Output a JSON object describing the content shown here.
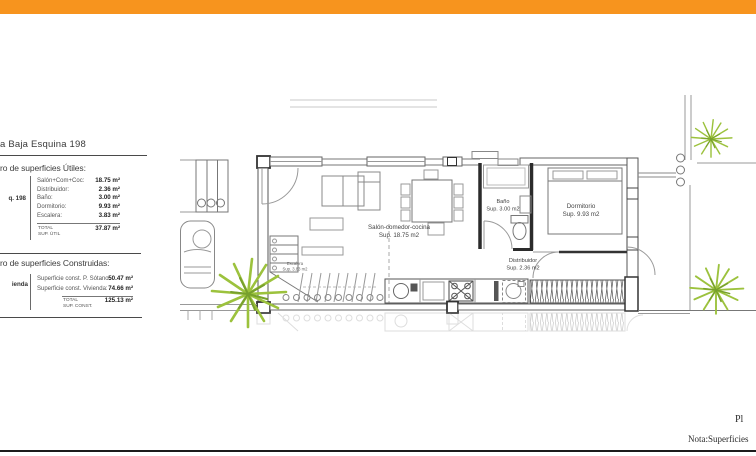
{
  "page": {
    "accent_bar_color": "#F7941E",
    "background": "#ffffff"
  },
  "title": "a Baja Esquina 198",
  "surfaces_utiles": {
    "heading": "ro de superficies Útiles:",
    "side_label": "q. 198",
    "rows": [
      {
        "label": "Salón+Com+Coc:",
        "value": "18.75 m²"
      },
      {
        "label": "Distribuidor:",
        "value": "2.36 m²"
      },
      {
        "label": "Baño:",
        "value": "3.00 m²"
      },
      {
        "label": "Dormitorio:",
        "value": "9.93 m²"
      },
      {
        "label": "Escalera:",
        "value": "3.83 m²"
      }
    ],
    "total": {
      "label_line1": "TOTAL",
      "label_line2": "SUP. ÚTIL",
      "value": "37.87 m²"
    }
  },
  "surfaces_construidas": {
    "heading": "ro de superficies Construidas:",
    "side_label": "ienda",
    "rows": [
      {
        "label": "Superficie const. P. Sótano:",
        "value": "50.47 m²"
      },
      {
        "label": "Superficie const. Vivienda:",
        "value": "74.66 m²"
      }
    ],
    "total": {
      "label_line1": "TOTAL",
      "label_line2": "SUP. CONST.",
      "value": "125.13 m²"
    }
  },
  "floor_plan": {
    "rooms": {
      "salon": {
        "name": "Salón-comedor-cocina",
        "area": "Sup. 18.75 m2"
      },
      "bano": {
        "name": "Baño",
        "area": "Sup. 3.00 m2"
      },
      "dormitorio": {
        "name": "Dormitorio",
        "area": "Sup. 9.93 m2"
      },
      "distribuidor": {
        "name": "Distribuidor",
        "area": "Sup. 2.36 m2"
      },
      "escalera": {
        "name": "Escalera",
        "area": "Sup. 3.83 m2"
      }
    },
    "plant_color": "#9cc23d"
  },
  "footer": {
    "clipped_text": "Pl",
    "note": "Nota:Superficies"
  }
}
